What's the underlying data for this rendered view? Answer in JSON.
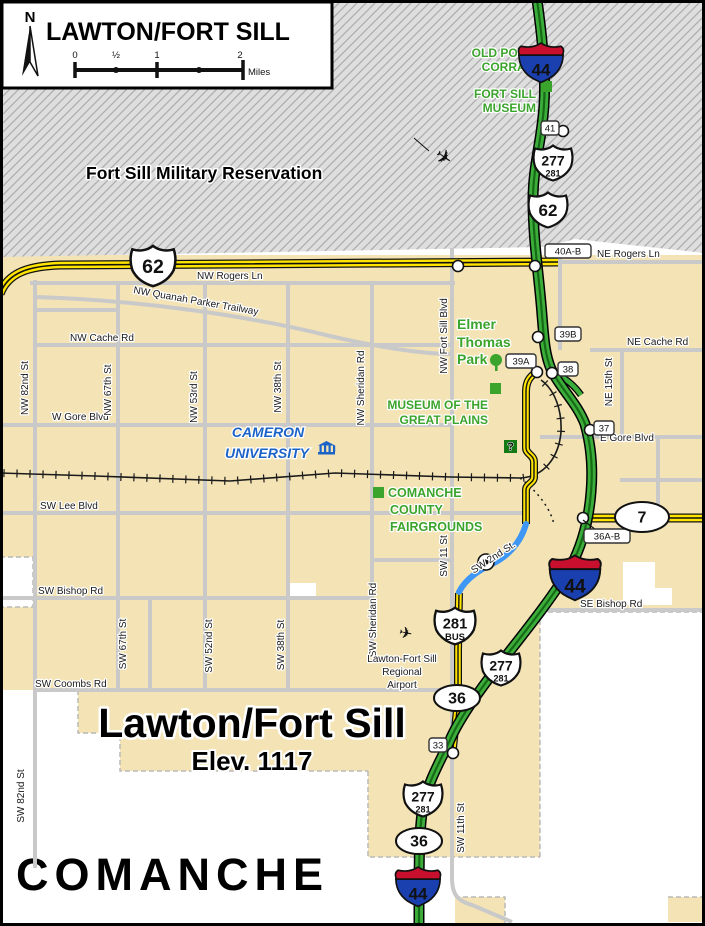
{
  "title_box": {
    "title": "LAWTON/FORT SILL",
    "north_label": "N",
    "scale": {
      "tick_labels": [
        "0",
        "½",
        "1",
        "2"
      ],
      "unit": "Miles"
    }
  },
  "colors": {
    "city_fill": "#F3E3B5",
    "reservation_fill": "#DEDEDE",
    "reservation_hatch": "#ABABAB",
    "street_gray": "#C9C9C9",
    "highway_yellow": "#FFE400",
    "turnpike_green": "#3CAD3A",
    "turnpike_dark": "#156B15",
    "construction_blue": "#3E97F5",
    "poi_green": "#3BA42C",
    "university_blue": "#1C63C8",
    "county_gray": "#CBCBCB",
    "interstate_red": "#C8102E",
    "interstate_blue": "#1A3FAE",
    "info_green": "#157A15"
  },
  "area_labels": {
    "reservation": "Fort Sill Military Reservation",
    "city_name": "Lawton/Fort Sill",
    "elevation": "Elev. 1117",
    "county": "COMANCHE"
  },
  "poi": {
    "old_post_corral": [
      "OLD POST",
      "CORRAL"
    ],
    "fort_sill_museum": [
      "FORT SILL",
      "MUSEUM"
    ],
    "elmer_thomas_park": [
      "Elmer",
      "Thomas",
      "Park"
    ],
    "museum_great_plains": [
      "MUSEUM OF THE",
      "GREAT PLAINS"
    ],
    "fairgrounds": [
      "COMANCHE",
      "COUNTY",
      "FAIRGROUNDS"
    ],
    "university": [
      "CAMERON",
      "UNIVERSITY"
    ],
    "airport": [
      "Lawton-Fort Sill",
      "Regional",
      "Airport"
    ],
    "info_symbol": "?"
  },
  "street_labels": [
    {
      "t": "NW Rogers Ln",
      "x": 197,
      "y": 279
    },
    {
      "t": "NE Rogers Ln",
      "x": 597,
      "y": 257
    },
    {
      "t": "NW Quanah Parker Trailway",
      "x": 133,
      "y": 293,
      "rot": 10
    },
    {
      "t": "NW Cache Rd",
      "x": 70,
      "y": 341
    },
    {
      "t": "NE Cache Rd",
      "x": 627,
      "y": 345
    },
    {
      "t": "W Gore Blvd",
      "x": 52,
      "y": 420
    },
    {
      "t": "E Gore Blvd",
      "x": 600,
      "y": 441
    },
    {
      "t": "SW Lee Blvd",
      "x": 40,
      "y": 509
    },
    {
      "t": "SW Bishop Rd",
      "x": 38,
      "y": 594
    },
    {
      "t": "SE Bishop Rd",
      "x": 580,
      "y": 607
    },
    {
      "t": "SW Coombs Rd",
      "x": 35,
      "y": 687
    },
    {
      "t": "SW 2nd St.",
      "x": 495,
      "y": 560,
      "rot": -33,
      "anchor": "middle"
    }
  ],
  "vertical_labels": [
    {
      "t": "NW 82nd St",
      "x": 28,
      "y": 388
    },
    {
      "t": "NW 67th St",
      "x": 111,
      "y": 390
    },
    {
      "t": "NW 53rd St",
      "x": 197,
      "y": 397
    },
    {
      "t": "NW 38th St",
      "x": 281,
      "y": 387
    },
    {
      "t": "NW Sheridan Rd",
      "x": 364,
      "y": 388
    },
    {
      "t": "NW Fort Sill Blvd",
      "x": 447,
      "y": 336
    },
    {
      "t": "NE 15th St",
      "x": 612,
      "y": 382
    },
    {
      "t": "SW 67th St",
      "x": 126,
      "y": 644
    },
    {
      "t": "SW 52nd St",
      "x": 212,
      "y": 646
    },
    {
      "t": "SW 38th St",
      "x": 284,
      "y": 645
    },
    {
      "t": "SW Sheridan Rd",
      "x": 376,
      "y": 620
    },
    {
      "t": "SW 11 St",
      "x": 447,
      "y": 556
    },
    {
      "t": "SW 11th St",
      "x": 464,
      "y": 828
    },
    {
      "t": "SW 82nd St",
      "x": 24,
      "y": 796
    }
  ],
  "shields": [
    {
      "type": "interstate",
      "num": "44",
      "x": 541,
      "y": 62,
      "s": 1.05
    },
    {
      "type": "interstate",
      "num": "44",
      "x": 575,
      "y": 577,
      "s": 1.2
    },
    {
      "type": "interstate",
      "num": "44",
      "x": 418,
      "y": 886,
      "s": 1.05
    },
    {
      "type": "us",
      "num": "277",
      "sub": "281",
      "x": 553,
      "y": 163,
      "s": 1
    },
    {
      "type": "us",
      "num": "62",
      "x": 548,
      "y": 210,
      "s": 1
    },
    {
      "type": "us",
      "num": "62",
      "x": 153,
      "y": 266,
      "s": 1.15
    },
    {
      "type": "us",
      "num": "281",
      "sub": "BUS",
      "x": 455,
      "y": 626,
      "s": 1.05
    },
    {
      "type": "us",
      "num": "277",
      "sub": "281",
      "x": 501,
      "y": 668,
      "s": 1
    },
    {
      "type": "us",
      "num": "277",
      "sub": "281",
      "x": 423,
      "y": 799,
      "s": 1
    },
    {
      "type": "oval",
      "num": "7",
      "x": 642,
      "y": 517,
      "rx": 27,
      "ry": 15
    },
    {
      "type": "oval",
      "num": "36",
      "x": 457,
      "y": 698,
      "rx": 23,
      "ry": 13
    },
    {
      "type": "oval",
      "num": "36",
      "x": 419,
      "y": 841,
      "rx": 23,
      "ry": 13
    }
  ],
  "exits": [
    {
      "label": "41",
      "x": 550,
      "y": 128,
      "w": 18
    },
    {
      "label": "40A-B",
      "x": 568,
      "y": 251,
      "w": 46
    },
    {
      "label": "39B",
      "x": 568,
      "y": 334,
      "w": 26
    },
    {
      "label": "39A",
      "x": 521,
      "y": 361,
      "w": 30
    },
    {
      "label": "38",
      "x": 568,
      "y": 369,
      "w": 20
    },
    {
      "label": "37",
      "x": 604,
      "y": 428,
      "w": 20
    },
    {
      "label": "36A-B",
      "x": 607,
      "y": 536,
      "w": 46,
      "leader": "M583,520 L596,530"
    },
    {
      "label": "33",
      "x": 438,
      "y": 745,
      "w": 18
    }
  ],
  "nodes": [
    {
      "x": 563,
      "y": 131
    },
    {
      "x": 458,
      "y": 266
    },
    {
      "x": 535,
      "y": 266
    },
    {
      "x": 538,
      "y": 337
    },
    {
      "x": 537,
      "y": 372
    },
    {
      "x": 552,
      "y": 373
    },
    {
      "x": 590,
      "y": 430
    },
    {
      "x": 583,
      "y": 518
    },
    {
      "x": 453,
      "y": 753
    },
    {
      "x": 486,
      "y": 562,
      "dot": true
    }
  ],
  "markers": {
    "green_squares": [
      {
        "x": 538,
        "y": 67
      },
      {
        "x": 541,
        "y": 81
      },
      {
        "x": 490,
        "y": 383
      },
      {
        "x": 373,
        "y": 487
      }
    ],
    "info_box": {
      "x": 504,
      "y": 440,
      "s": 13
    },
    "tree": {
      "x": 496,
      "y": 362
    },
    "jet": {
      "x": 433,
      "y": 158,
      "rot": 35
    },
    "plane": {
      "x": 398,
      "y": 637,
      "rot": 12
    },
    "building_icon": {
      "x": 318,
      "y": 443
    }
  },
  "geometry": {
    "reservation_poly": "0,0 705,0 705,253 575,239 545,247 0,257",
    "tan_areas": [
      {
        "x": 0,
        "y": 255,
        "w": 705,
        "h": 357
      },
      {
        "x": 0,
        "y": 612,
        "w": 460,
        "h": 78
      },
      {
        "x": 455,
        "y": 612,
        "w": 85,
        "h": 160
      },
      {
        "x": 78,
        "y": 690,
        "w": 382,
        "h": 43
      },
      {
        "x": 120,
        "y": 733,
        "w": 340,
        "h": 38
      },
      {
        "x": 368,
        "y": 770,
        "w": 172,
        "h": 87
      },
      {
        "x": 455,
        "y": 897,
        "w": 50,
        "h": 29
      },
      {
        "x": 668,
        "y": 897,
        "w": 37,
        "h": 25
      }
    ],
    "white_areas": [
      {
        "x": 0,
        "y": 557,
        "w": 33,
        "h": 50
      },
      {
        "x": 623,
        "y": 562,
        "w": 32,
        "h": 43
      },
      {
        "x": 623,
        "y": 588,
        "w": 49,
        "h": 17
      },
      {
        "x": 288,
        "y": 583,
        "w": 28,
        "h": 16
      }
    ],
    "boundaries": [
      "M0,557 L33,557 L33,607 L0,607",
      "M78,690 L78,733 L120,733 L120,771 L368,771",
      "M368,771 L368,857 L540,857",
      "M540,612 L540,857",
      "M540,612 L705,612",
      "M455,897 L505,897 L505,926",
      "M668,897 L705,897"
    ],
    "gray_roads": [
      "M35,280 L35,868",
      "M118,282 L118,690",
      "M205,282 L205,690",
      "M288,283 L288,690",
      "M372,283 L372,645",
      "M452,248 L452,878 C452,895 458,901 472,905 L512,922",
      "M622,350 L622,438",
      "M560,252 L560,350",
      "M658,437 L658,518",
      "M30,283 L455,283",
      "M545,262 L705,262",
      "M35,297 C140,300 250,316 330,336 C390,350 430,354 452,354",
      "M35,345 L452,345",
      "M590,350 L705,350",
      "M0,425 L452,425",
      "M540,437 L705,437",
      "M0,513 L527,513",
      "M0,598 L372,598",
      "M540,610 L705,610",
      "M35,690 L460,690",
      "M372,560 L452,560",
      "M150,598 L150,690",
      "M620,480 L705,480",
      "M35,310 L118,310"
    ],
    "rail_main": "M0,473 L95,476 L230,481 L335,473 L450,477 L520,478 C545,477 559,456 561,432 C562,410 555,390 541,380",
    "rail_dotted": "M520,478 C538,492 550,508 554,524",
    "yellow_divided": [
      "M0,294 C8,272 30,266 60,265 L558,262",
      "M586,518 L705,518"
    ],
    "yellow_minor": [
      "M537,372 C528,377 526,384 526,392 L526,448 C526,454 534,455 534,462 L534,477 C534,483 526,484 526,490 L526,524",
      "M459,593 L458,650 L458,700 L453,748"
    ],
    "blue_road": "M526,524 C520,545 505,558 492,564 C480,570 466,578 459,592",
    "green_main": "M537,0 C542,35 546,75 544,105 C542,140 533,165 533,200 C533,240 539,275 542,315 C544,340 545,355 551,369 C560,388 577,403 585,424 C591,445 593,468 591,492 C589,518 583,543 571,566 C557,591 532,623 506,656 C480,689 459,719 450,740 C442,758 428,781 423,806 C419,831 419,856 419,926",
    "green_spur": "M552,372 C564,377 574,385 581,395",
    "contrail": "M414,138 L429,151"
  }
}
